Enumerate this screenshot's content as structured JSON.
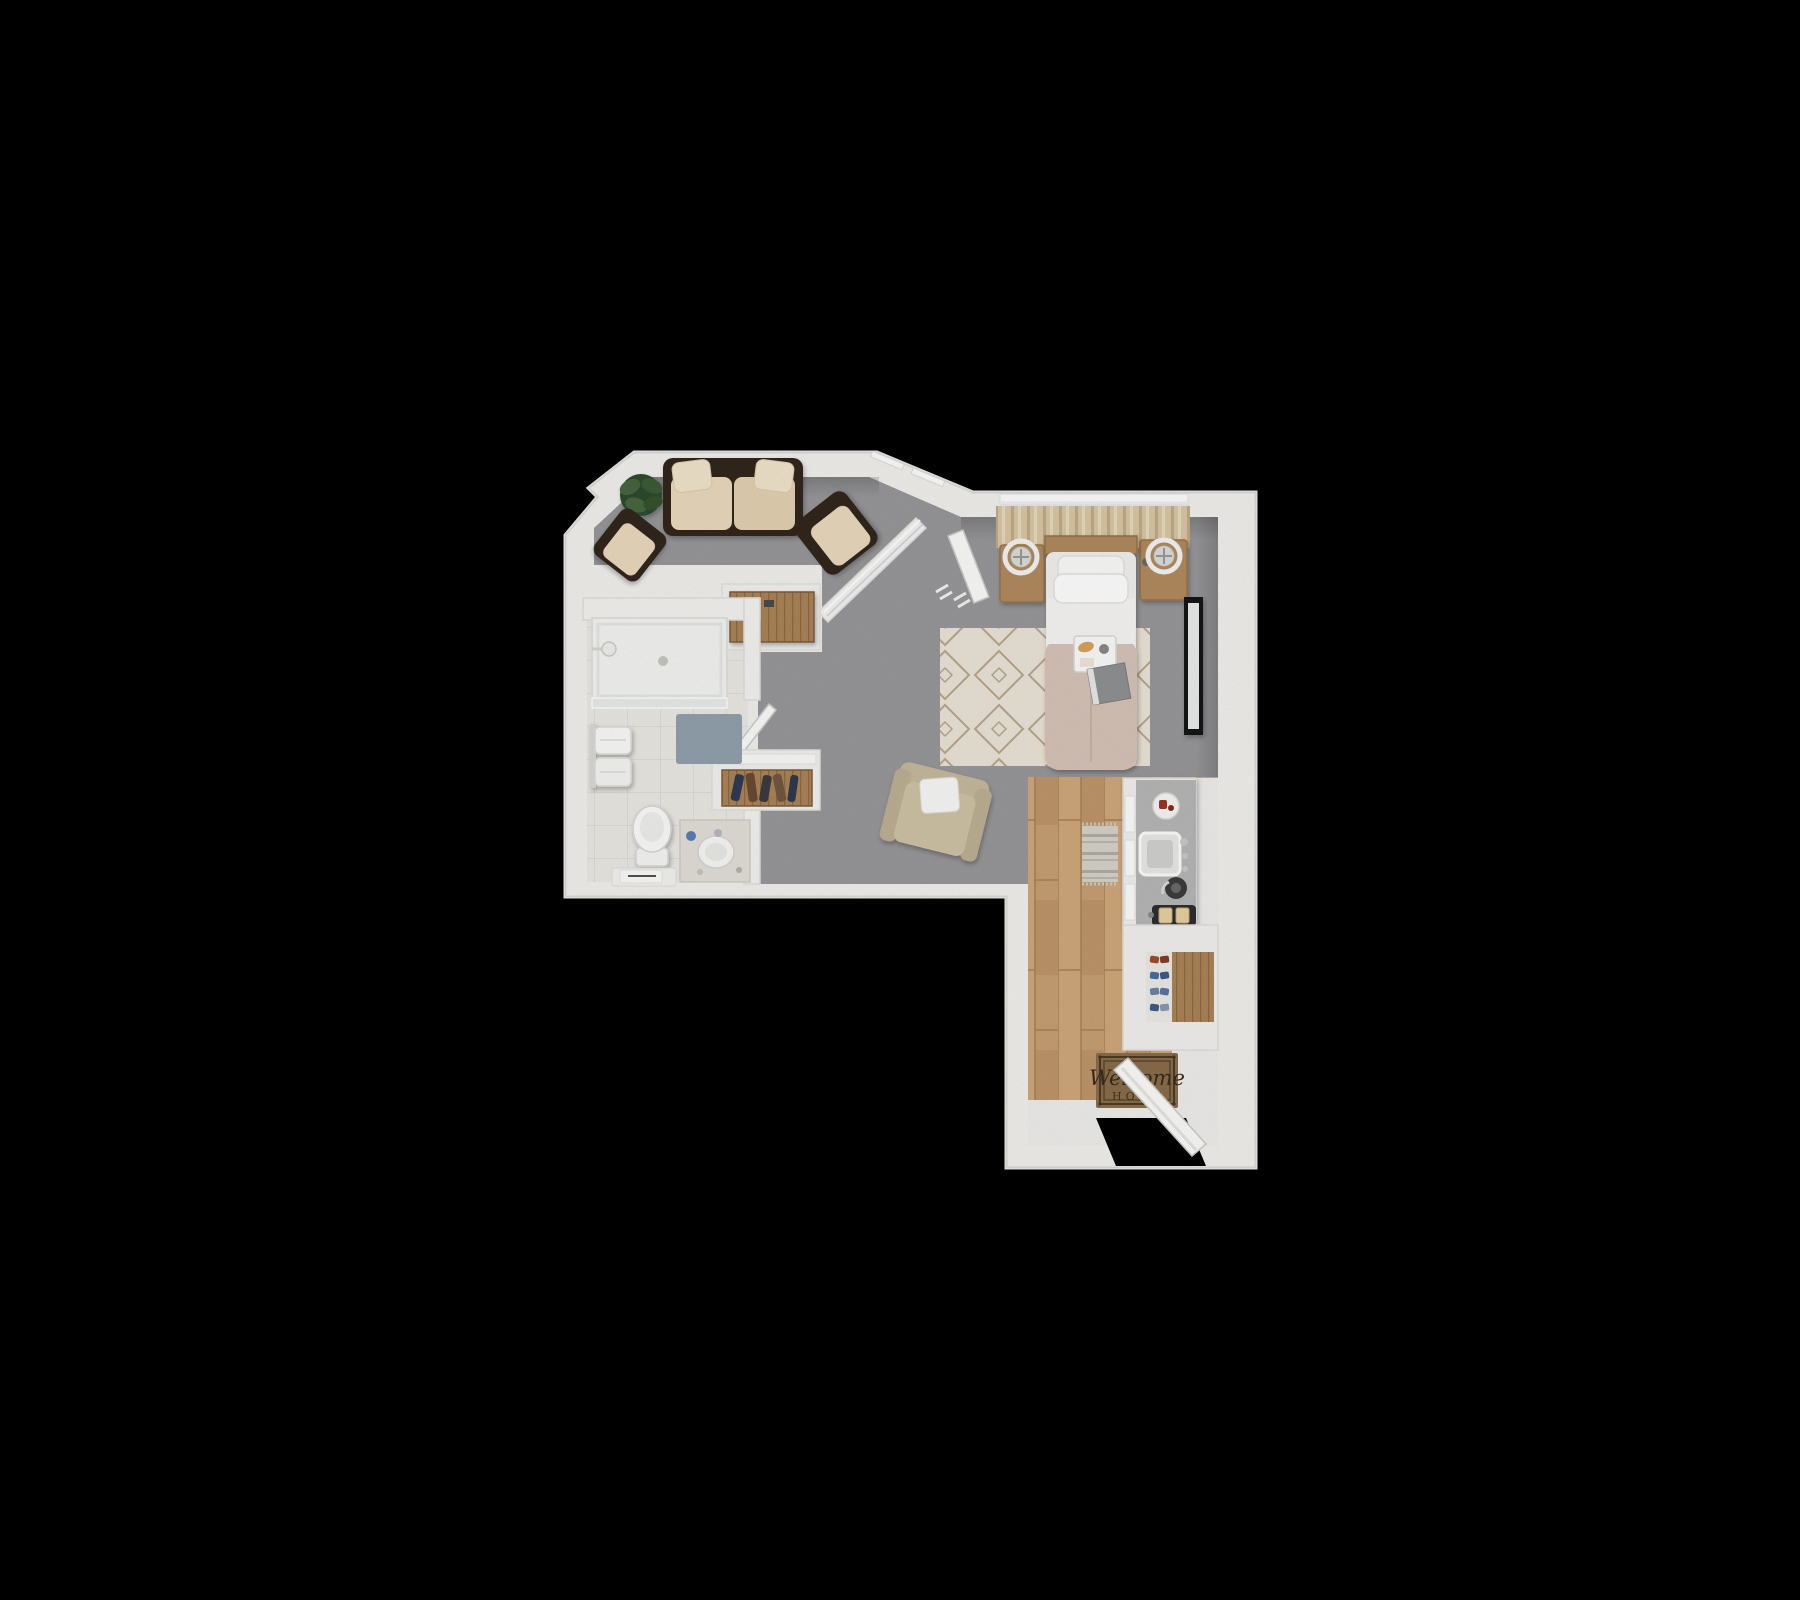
{
  "scene": {
    "type": "3d-floor-plan-render",
    "view": "top-down",
    "background_color": "#000000"
  },
  "palette": {
    "wall": "#f2f1ee",
    "carpet": "#98989b",
    "wood_floor": "#c79f73",
    "bathroom_tile": "#ebe9e4",
    "entry_tile": "#efeeec",
    "sofa_frame": "#33251b",
    "cushion_cream": "#ead9bd",
    "duvet_blush": "#d7c3b8",
    "bedroom_rug": "#ebe4d7",
    "nightstand_wood": "#b28a5e",
    "curtain": "#d9c7a6",
    "bath_mat": "#91a1ad",
    "counter_top": "#b7b7b8",
    "welcome_mat": "#8a6d4b",
    "mirror_frame": "#141414",
    "plant_green": "#3c5c38",
    "lounge_chair_beige": "#cfc2a6"
  },
  "rooms": [
    {
      "name": "living-room",
      "floor": "gray-carpet",
      "furniture": [
        "sofa",
        "accent-chair-left",
        "accent-chair-right",
        "potted-plant"
      ]
    },
    {
      "name": "bedroom",
      "floor": "gray-carpet",
      "furniture": [
        "bed",
        "headboard",
        "pillows",
        "breakfast-tray",
        "book",
        "nightstand-left",
        "nightstand-right",
        "table-fan-left",
        "table-fan-right",
        "curtains",
        "area-rug",
        "floor-mirror",
        "lounge-chair",
        "drying-rack"
      ]
    },
    {
      "name": "bathroom",
      "floor": "white-tile",
      "furniture": [
        "walk-in-shower",
        "shower-head",
        "bath-mat",
        "towel-rack",
        "toilet",
        "towel-bench",
        "vanity-sink",
        "bathroom-door"
      ]
    },
    {
      "name": "hall-closets",
      "furniture": [
        "closet-dresser",
        "closet-clothes-rack",
        "bedroom-door"
      ]
    },
    {
      "name": "kitchen-entry",
      "floor": "wood-planks",
      "furniture": [
        "kitchen-counter",
        "kitchen-sink",
        "dish-plate",
        "kettle",
        "toaster",
        "kitchen-runner-rug",
        "shoe-closet",
        "welcome-mat",
        "entry-door"
      ]
    }
  ],
  "entry": {
    "mat_line1": "Welcome",
    "mat_line2": "HOME"
  }
}
